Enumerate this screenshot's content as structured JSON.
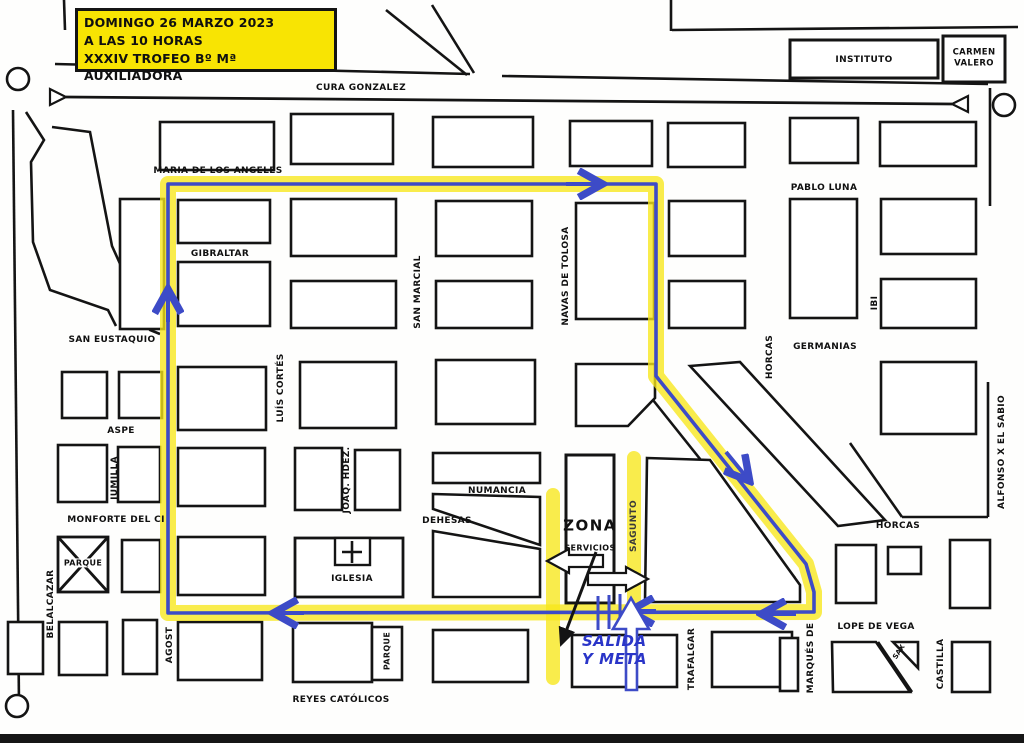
{
  "title_box": {
    "line1": "DOMINGO 26 MARZO 2023",
    "line2": "A LAS 10 HORAS",
    "line3": "XXXIV TROFEO Bº Mª AUXILIADORA"
  },
  "buildings": {
    "instituto": "INSTITUTO",
    "carmen_valero_line1": "CARMEN",
    "carmen_valero_line2": "VALERO",
    "iglesia": "IGLESIA",
    "parque_cross": "PARQUE",
    "parque_small": "PARQUE",
    "zona": "ZONA",
    "zona_sub": "SERVICIOS"
  },
  "streets": {
    "cura_gonzalez": "CURA GONZALEZ",
    "maria_de_los_angeles": "MARIA DE LOS ANGELES",
    "pablo_luna": "PABLO LUNA",
    "gibraltar": "GIBRALTAR",
    "san_marcial": "SAN MARCIAL",
    "navas_de_tolosa": "NAVAS DE TOLOSA",
    "ibi": "IBI",
    "san_eustaquio": "SAN EUSTAQUIO",
    "luis_cortes": "LUÍS CORTÉS",
    "germanias": "GERMANIAS",
    "horcas_upper": "HORCAS",
    "horcas_right": "HORCAS",
    "aspe": "ASPE",
    "jumilla": "JUMILLA",
    "joaq_hdez": "JOAQ. HDEZ.",
    "alfonso_x": "ALFONSO X EL SABIO",
    "monforte": "MONFORTE DEL CI",
    "numancia": "NUMANCIA",
    "dehesas": "DEHESAS",
    "belalcazar": "BELALCAZAR",
    "sagunto": "SAGUNTO",
    "agost": "AGOST",
    "trafalgar": "TRAFALGAR",
    "marques_de": "MARQUÉS DE",
    "sax": "SAX",
    "castilla": "CASTILLA",
    "lope_de_vega": "LOPE DE VEGA",
    "reyes_catolicos": "REYES CATÓLICOS"
  },
  "route": {
    "salida_line1": "SALIDA",
    "salida_line2": "Y META"
  },
  "colors": {
    "route_yellow": "#f7e71a",
    "route_blue": "#3d4bc7",
    "title_bg": "#f8e403",
    "ink": "#141414"
  }
}
